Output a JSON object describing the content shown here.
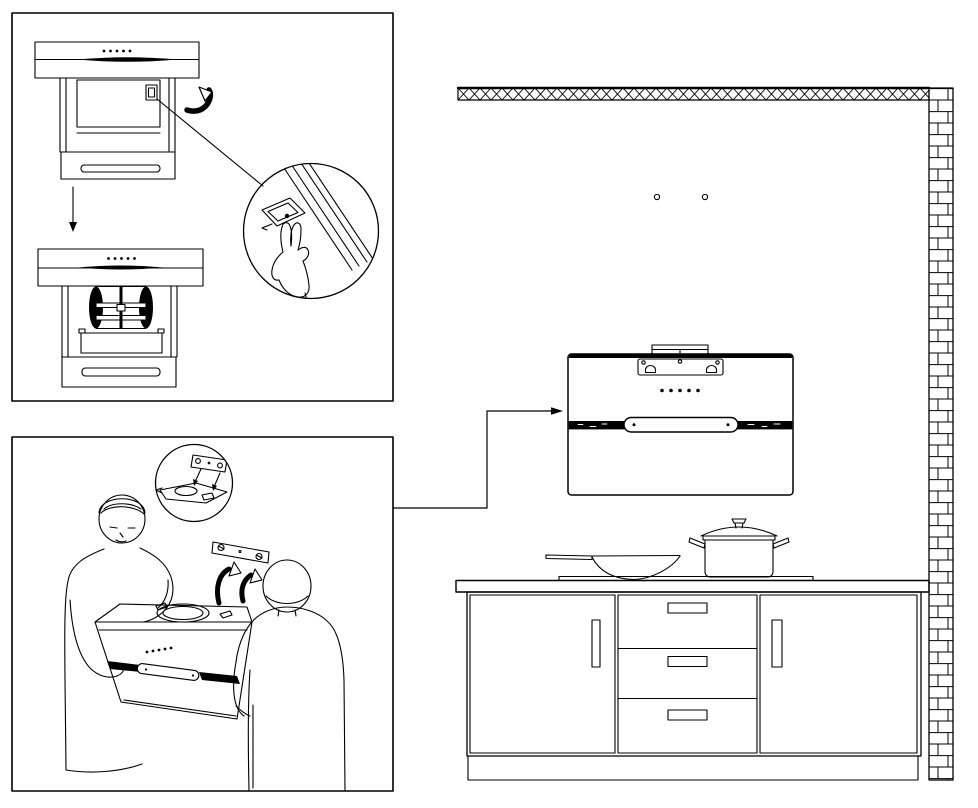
{
  "canvas": {
    "width": 978,
    "height": 808,
    "background": "#ffffff",
    "ink": "#000000"
  },
  "diagram": {
    "kind": "cooker-hood-installation-manual-figure",
    "panels": [
      {
        "id": "filter-removal",
        "hood_views": 2,
        "control_dots": 5,
        "detail_view": "hand-pressing-filter-latch",
        "arrows": [
          "rotate-latch",
          "step-down"
        ]
      },
      {
        "id": "hood-hanging",
        "installers": 2,
        "detail_view": "bracket-alignment",
        "hang_arrows": 2,
        "control_dots": 5,
        "wall_bracket_screws": 2
      }
    ],
    "kitchen": {
      "wall_mount_holes": 2,
      "hood": {
        "control_dots": 5,
        "mounting_plate_holes": 3,
        "keyhole_slots": 2,
        "handle_screws": 2
      },
      "cookware": [
        "wok",
        "lidded-pot"
      ],
      "cabinet": {
        "doors": 2,
        "drawers": 3,
        "drawer_handles": 3,
        "door_handles": 2
      }
    }
  }
}
